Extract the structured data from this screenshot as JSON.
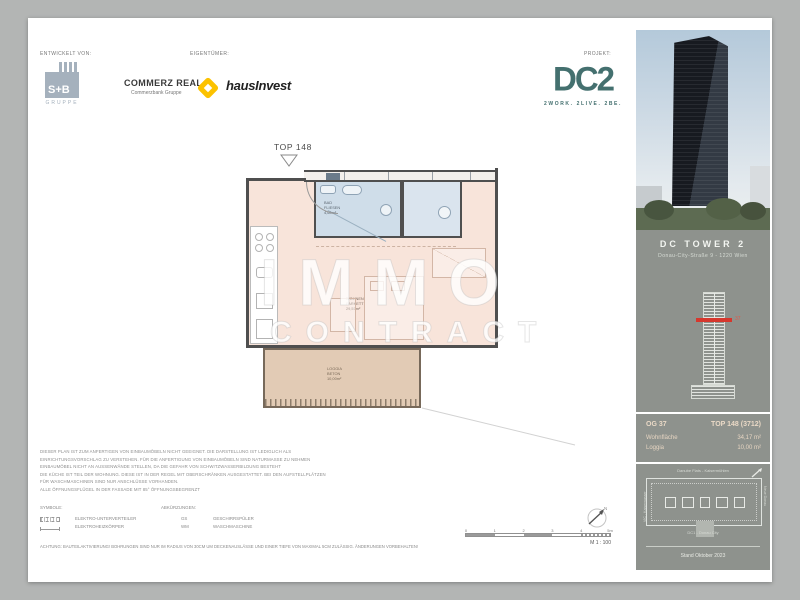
{
  "header": {
    "developed_label": "ENTWICKELT VON:",
    "owner_label": "EIGENTÜMER:",
    "project_label": "PROJEKT:",
    "sb_logo": {
      "name": "S+B",
      "sub": "GRUPPE"
    },
    "commerz": {
      "name": "COMMERZ REAL",
      "sub": "Commerzbank Gruppe"
    },
    "hausinvest": "hausInvest",
    "dc2": {
      "name": "DC2",
      "tagline": "2WORK. 2LIVE. 2BE."
    }
  },
  "plan": {
    "unit_label": "TOP 148",
    "rooms": {
      "bath": {
        "name": "BAD",
        "floor": "FLIESEN",
        "area": "4,60m²"
      },
      "living": {
        "name": "WOHNEN",
        "floor": "PARKETT",
        "area": "29,57m²"
      },
      "loggia": {
        "name": "LOGGIA",
        "floor": "BETON",
        "area": "10,00m²"
      }
    }
  },
  "watermark": {
    "line1": "IMMO",
    "line2": "CONTRACT"
  },
  "sidebar": {
    "title": "DC TOWER 2",
    "address": "Donau-City-Straße 9 - 1220 Wien",
    "floor_marker": "37",
    "info": {
      "floor": "OG 37",
      "unit": "TOP 148 (3712)",
      "rows": [
        {
          "label": "Wohnfläche",
          "value": "34,17 m²"
        },
        {
          "label": "Loggia",
          "value": "10,00 m²"
        }
      ]
    },
    "siteplan": {
      "top": "Danube Flats - Kaisermühlen",
      "left": "VIC - Kaiserwasser",
      "right": "Neue Donau",
      "bottom": "DC1 - Donau City"
    },
    "stand": "Stand Oktober 2023"
  },
  "legal": {
    "lines": [
      "DIESER PLAN IST ZUM ANFERTIGEN VON EINBAUMÖBELN NICHT GEEIGNET. DIE DARSTELLUNG IST LEDIGLICH ALS",
      "EINRICHTUNGSVORSCHLAG ZU VERSTEHEN. FÜR DIE ANFERTIGUNG VON EINBAUMÖBELN SIND NATURMASSE ZU NEHMEN",
      "EINBAUMÖBEL NICHT AN AUSSENWÄNDE STELLEN, DA DIE GEFAHR VON SCHWITZWASSERBILDUNG BESTEHT",
      "DIE KÜCHE IST TEIL DER WOHNUNG. DIESE IST IN DER REGEL MIT OBERSCHRÄNKEN AUSGESTATTET. BEI DEN AUFSTELLPLÄTZEN",
      "FÜR WASCHMASCHINEN SIND NUR ANSCHLÜSSE VORHANDEN.",
      "ALLE ÖFFNUNGSFLÜGEL IN DER FASSADE MIT 85° ÖFFNUNGSBEGRENZT"
    ]
  },
  "legend": {
    "symbols_label": "SYMBOLE:",
    "abbrev_label": "ABKÜRZUNGEN:",
    "symbols": [
      {
        "label": "ELEKTRO-UNTERVERTEILER"
      },
      {
        "label": "ELEKTROHEIZKÖRPER"
      }
    ],
    "abbrevs": [
      {
        "key": "GS",
        "label": "GESCHIRRSPÜLER"
      },
      {
        "key": "WM",
        "label": "WASCHMASCHINE"
      }
    ],
    "warning": "ACHTUNG: BAUTEILAKTIVIERUNG! BOHRUNGEN SIND NUR IM RADIUS VON 30CM UM DECKENAUSLÄSSE UND EINER TIEFE VON MAXIMAL 5CM ZULÄSSIG. ÄNDERUNGEN VORBEHALTEN!",
    "north_label": "N"
  },
  "scalebar": {
    "ticks": [
      "0",
      "1",
      "2",
      "3",
      "4",
      "5m"
    ],
    "scale": "M 1 : 100"
  },
  "colors": {
    "teal": "#44706f",
    "red": "#d6372d",
    "peach": "#f8e4da",
    "bath_blue": "#cfdde9",
    "loggia_tan": "#e2cbb5",
    "sidebar_gray": "#8e928d",
    "commerz_yellow": "#fcc200",
    "sb_blue": "#a5b1bd"
  }
}
